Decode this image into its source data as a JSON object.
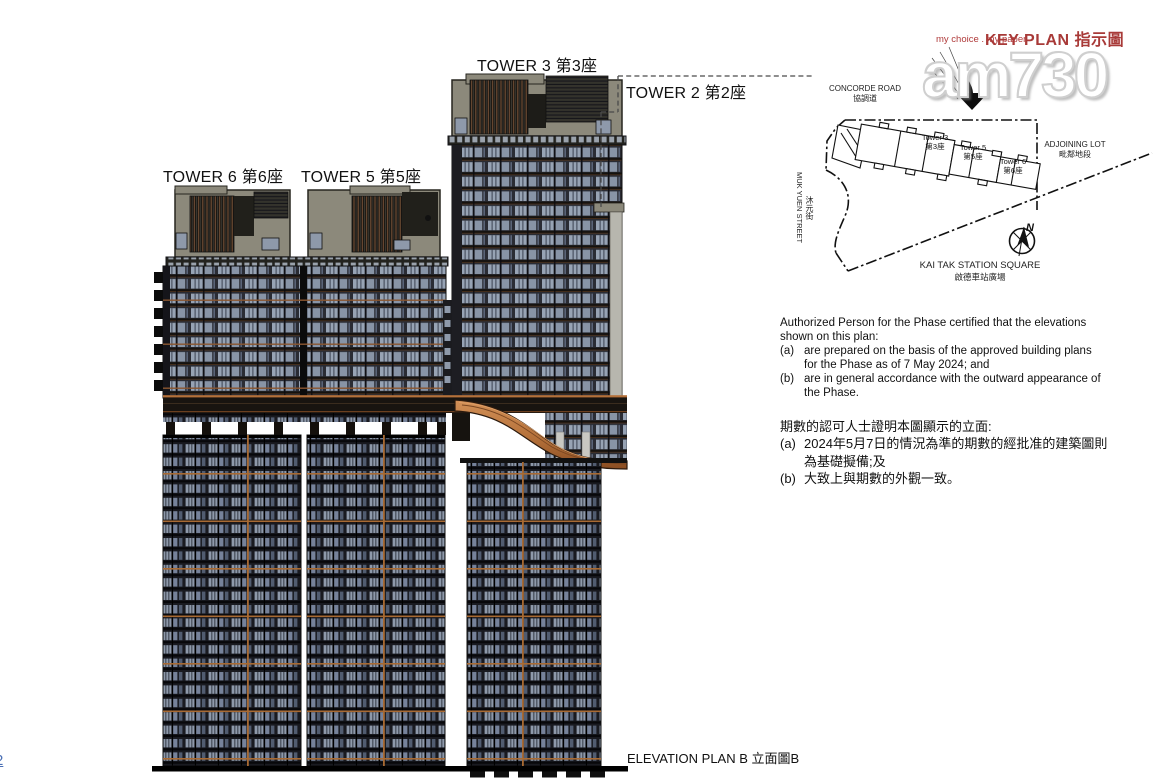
{
  "page": {
    "number": "2"
  },
  "watermark": {
    "brand": "am730",
    "tagline": "my choice . my paper"
  },
  "elevation": {
    "labels": {
      "tower3": "TOWER 3 第3座",
      "tower2": "TOWER 2 第2座",
      "tower6": "TOWER 6 第6座",
      "tower5": "TOWER 5 第5座"
    },
    "caption_en": "ELEVATION PLAN B",
    "caption_zh": "立面圖B"
  },
  "key_plan": {
    "title_en": "KEY PLAN",
    "title_zh": "指示圖",
    "north_label": "N",
    "roads": {
      "concorde_en": "CONCORDE ROAD",
      "concorde_zh": "協調道",
      "muk_yuen_en": "MUK YUEN STREET",
      "muk_yuen_zh": "沐元街",
      "adjoining_en": "ADJOINING LOT",
      "adjoining_zh": "毗鄰地段",
      "square_en": "KAI TAK STATION SQUARE",
      "square_zh": "啟德車站廣場"
    },
    "towers": [
      {
        "en": "Tower 3",
        "zh": "第3座"
      },
      {
        "en": "Tower 5",
        "zh": "第5座"
      },
      {
        "en": "Tower 6",
        "zh": "第6座"
      }
    ]
  },
  "certification_en": {
    "intro": "Authorized Person for the Phase certified that the elevations shown on this plan:",
    "items": [
      {
        "label": "(a)",
        "text": "are prepared on the basis of the approved building plans for the Phase as of 7 May 2024; and"
      },
      {
        "label": "(b)",
        "text": "are in general accordance with the outward appearance of the Phase."
      }
    ]
  },
  "certification_zh": {
    "intro": "期數的認可人士證明本圖顯示的立面:",
    "items": [
      {
        "label": "(a)",
        "text": "2024年5月7日的情況為準的期數的經批准的建築圖則為基礎擬備;及"
      },
      {
        "label": "(b)",
        "text": "大致上與期數的外觀一致。"
      }
    ]
  },
  "colors": {
    "copper_accent": "#b5713a",
    "window_glass": "#8e99aa",
    "crown_grey": "#8c897b",
    "keyplan_title_red": "#a83a38",
    "page_number_blue": "#4a6fb5",
    "tagline_red": "#b03a3a"
  }
}
